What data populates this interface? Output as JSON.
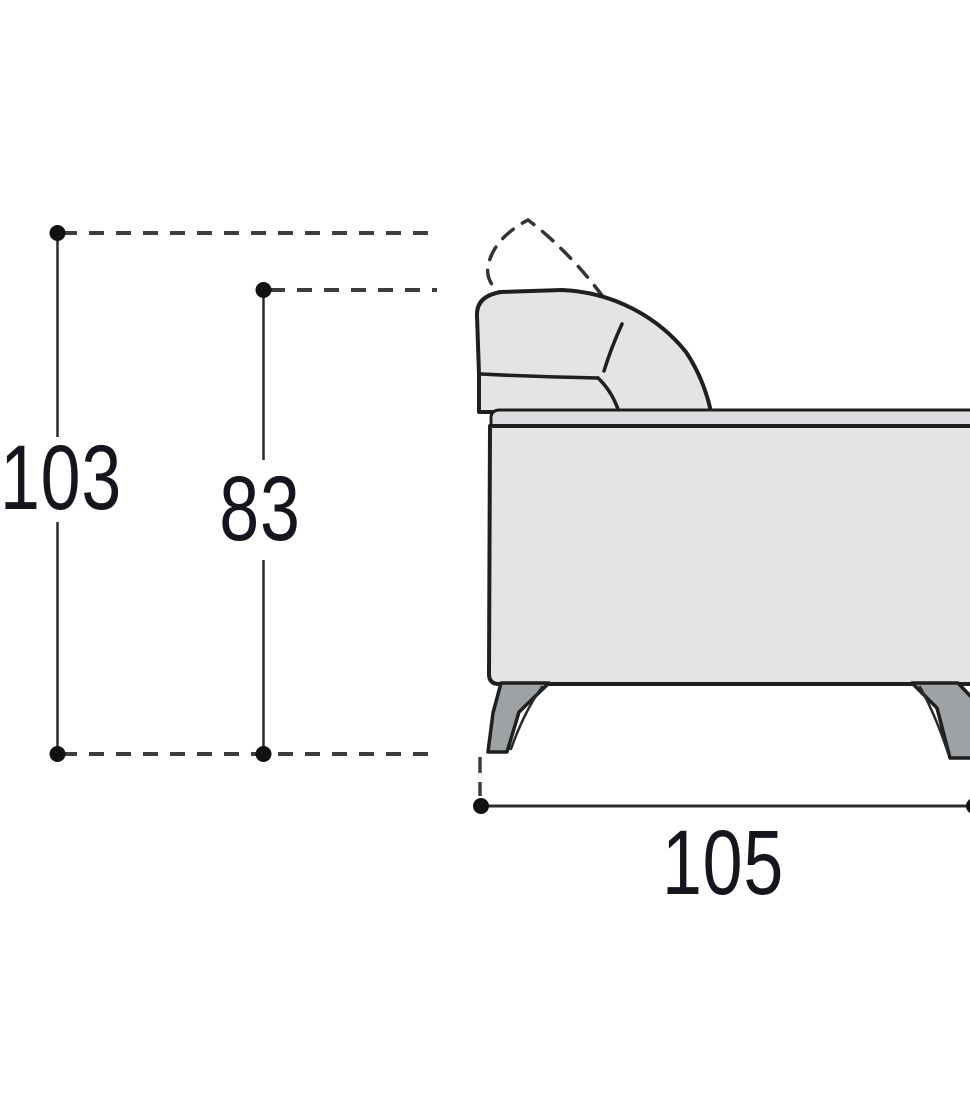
{
  "diagram": {
    "subject": "sofa-side-view-dimension-drawing",
    "labels": {
      "overall_height": "103",
      "backrest_height": "83",
      "depth": "105"
    },
    "colors": {
      "outline": "#1f1f1f",
      "sofa_fill": "#e3e4e4",
      "rail_fill": "#dbdcde",
      "leg_fill": "#9ea2a4",
      "dim_line": "#3d3d3d",
      "dot": "#111111",
      "label_text": "#15151d",
      "background": "#ffffff"
    }
  }
}
